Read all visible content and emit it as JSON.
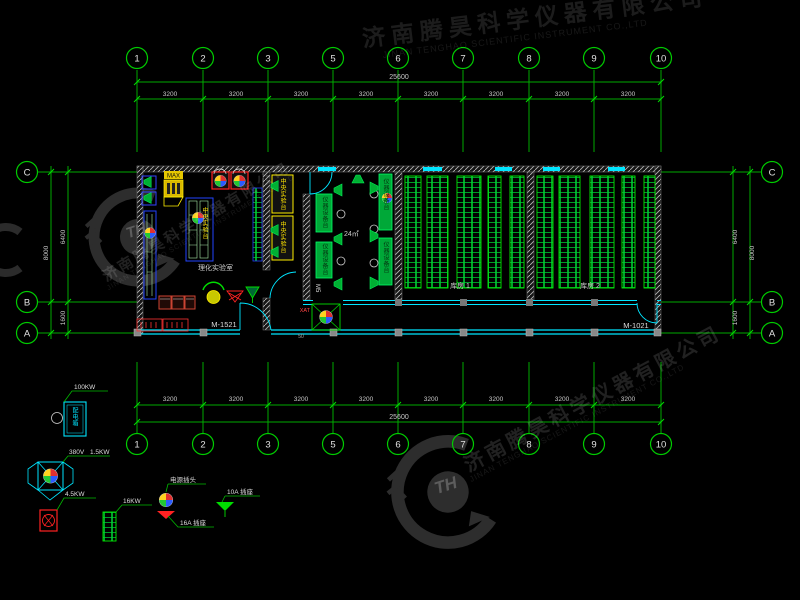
{
  "axes": {
    "top": {
      "labels": [
        "1",
        "2",
        "3",
        "5",
        "6",
        "7",
        "8",
        "9",
        "10"
      ]
    },
    "bottom": {
      "labels": [
        "1",
        "2",
        "3",
        "5",
        "6",
        "7",
        "8",
        "9",
        "10"
      ]
    },
    "left": {
      "labels": [
        "C",
        "B",
        "A"
      ]
    },
    "right": {
      "labels": [
        "C",
        "B",
        "A"
      ]
    }
  },
  "dims": {
    "bay": "3200",
    "total_h": "25600",
    "cb": "6400",
    "ba": "1600",
    "total_v": "8000",
    "door_note": "50"
  },
  "plan": {
    "lab_label": "理化实验室",
    "area_label": "24㎡",
    "store1_label": "库房 1",
    "store2_label": "库房 2",
    "door1": "M-1521",
    "door2": "M-1021",
    "door3": "M5",
    "bench_central": "中央实验台",
    "bench_side": "仪器设备台",
    "hood_tag": "MAX",
    "fan_tag": "XAT"
  },
  "legend": {
    "distribution_box": {
      "label": "配电箱",
      "rating": "100KW"
    },
    "fan": {
      "voltage": "380V",
      "power": "1.5KW"
    },
    "device_red": {
      "power": "4.5KW"
    },
    "rack": {
      "power": "16KW"
    },
    "plug": {
      "label": "电源插头"
    },
    "socket_16a": {
      "label": "16A 插座"
    },
    "socket_10a": {
      "label": "10A 插座"
    }
  },
  "watermark": {
    "company_cn": "济南腾昊科学仪器有限公司",
    "company_en": "JINAN TENGHAO SCIENTIFIC INSTRUMENT CO.,LTD",
    "logo_text": "TH"
  },
  "colors": {
    "grid_green": "#00bb00",
    "wall_cyan": "#00e5ff",
    "bench_blue": "#2244ff",
    "accent_yellow": "#ffe400",
    "accent_red": "#ff2222",
    "equipment_green": "#00ee55"
  }
}
